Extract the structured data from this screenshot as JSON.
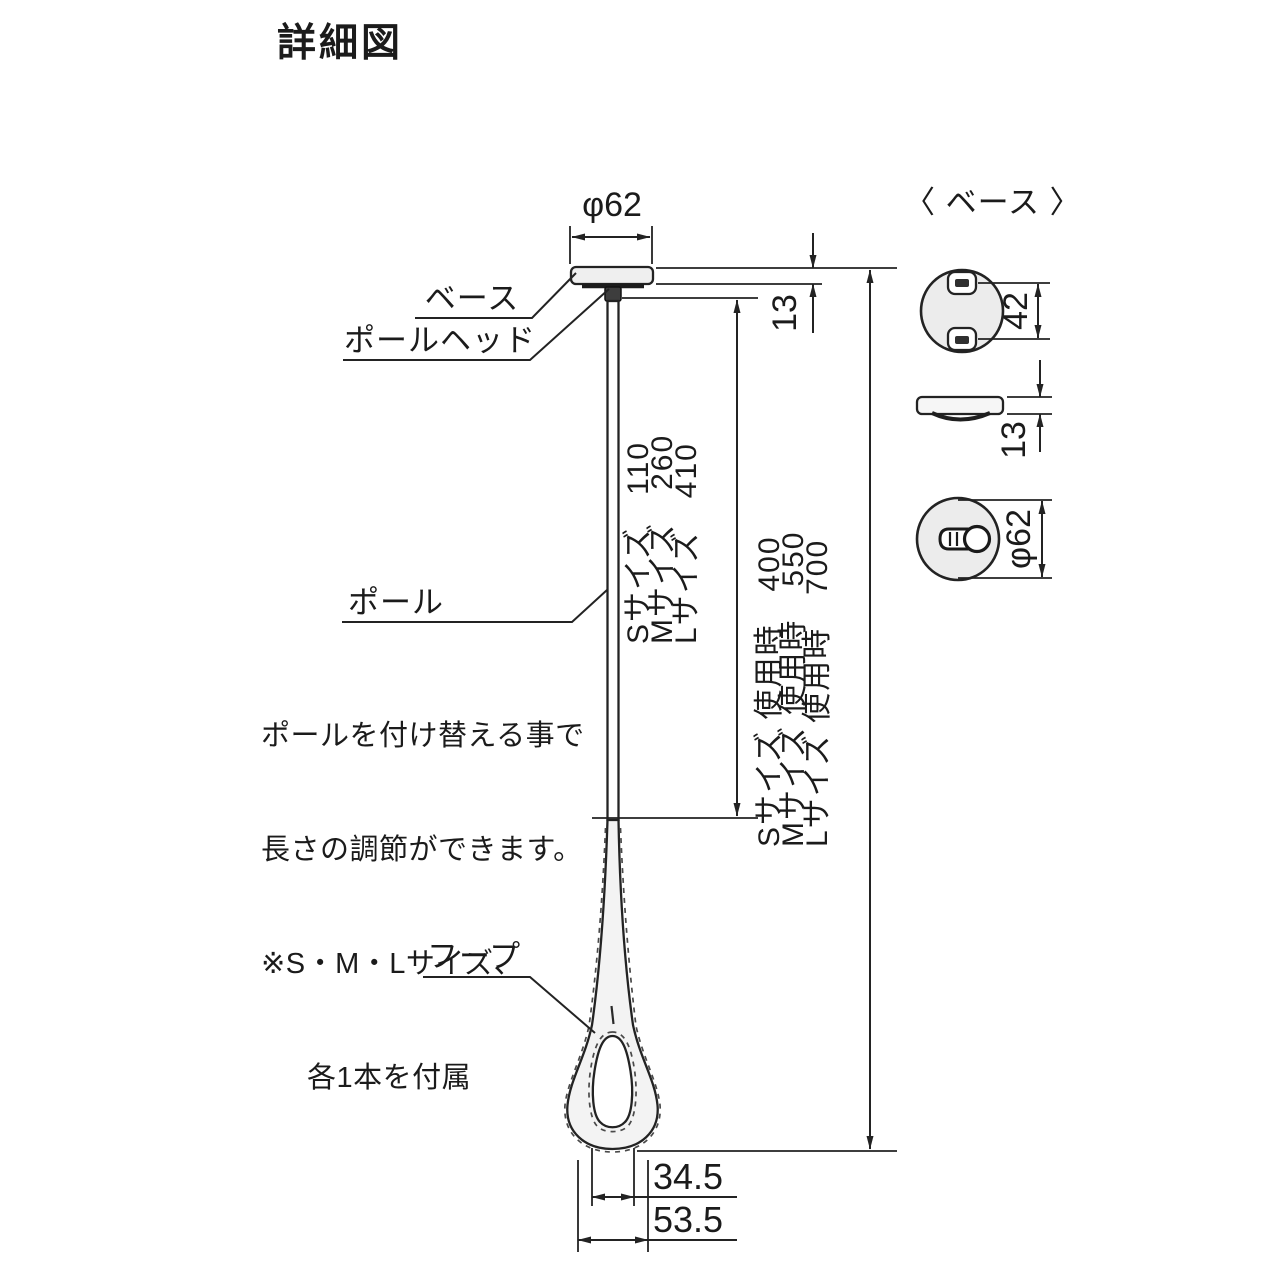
{
  "title": "詳細図",
  "colors": {
    "line": "#232323",
    "fill_light": "#efefef",
    "background": "#ffffff"
  },
  "main_diagram": {
    "labels": {
      "base": "ベース",
      "pole_head": "ポールヘッド",
      "pole": "ポール",
      "hoop": "フープ"
    },
    "note_lines": [
      "ポールを付け替える事で",
      "長さの調節ができます。",
      "※S・M・Lサイズ、",
      "各1本を付属"
    ],
    "dimensions": {
      "base_diameter": "φ62",
      "base_thickness": "13",
      "pole_lengths": [
        "Sサイズ　110",
        "Mサイズ　260",
        "Lサイズ　410"
      ],
      "overall_lengths": [
        "Sサイズ 使用時　400",
        "Mサイズ 使用時　550",
        "Lサイズ 使用時　700"
      ],
      "hoop_inner_width": "34.5",
      "hoop_outer_width": "53.5"
    }
  },
  "base_detail": {
    "heading": "〈 ベース 〉",
    "dimensions": {
      "screw_pitch": "42",
      "thickness": "13",
      "diameter": "φ62"
    }
  }
}
